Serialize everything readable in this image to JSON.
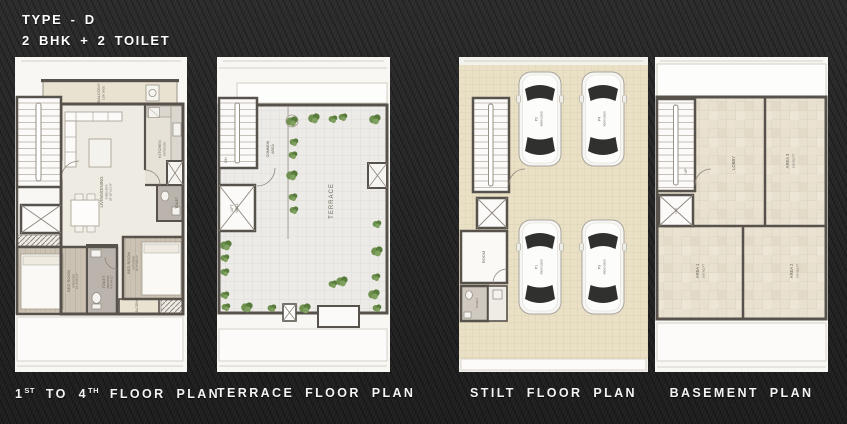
{
  "header": {
    "title": "TYPE - D",
    "subtitle": "2 BHK + 2 TOILET"
  },
  "captions": {
    "plan1": {
      "p1": "1",
      "s1": "ST",
      "p2": " TO 4",
      "s2": "TH",
      "p3": " FLOOR PLAN"
    },
    "plan2": "TERRACE FLOOR PLAN",
    "plan3": "STILT FLOOR PLAN",
    "plan4": "BASEMENT PLAN"
  },
  "floor_plan": {
    "balcony_top": "BALCONY",
    "balcony_top_dim": "1200 WIDE",
    "living": "LIVING/DINING",
    "living_dim_mm": "6300X3550",
    "living_dim_ft": "20'-10\"X11'-8\"",
    "kitchen": "KITCHEN",
    "kitchen_dim_mm": "2475X2150",
    "bedroom_a": "BED ROOM",
    "bedroom_a_dim_mm": "3750X3350",
    "bedroom_a_dim_ft": "12'-4\"X11'-0\"",
    "toilet_a": "TOILET",
    "toilet_a_dim_mm": "2600X1500",
    "toilet_a_dim_ft": "8'-6\"X4'-11\"",
    "bedroom_b": "BED ROOM",
    "bedroom_b_dim_mm": "3175X3050",
    "bedroom_b_dim_ft": "10'-5\"X10'-0\"",
    "toilet_b": "TOILET",
    "balcony_b": "BALCONY"
  },
  "terrace_plan": {
    "stairs": "DN",
    "lift_line1": "LIFT",
    "lift_line2": "WELL",
    "common_line1": "COMMON",
    "common_line2": "AREA",
    "terrace": "TERRACE"
  },
  "stilt_plan": {
    "room": "ROOM",
    "toilet": "TOILET",
    "cars": [
      {
        "id": "P2",
        "size": "4500X2500"
      },
      {
        "id": "P4",
        "size": "4500X2500"
      },
      {
        "id": "P1",
        "size": "4500X2500"
      },
      {
        "id": "P3",
        "size": "4500X2500"
      }
    ]
  },
  "basement_plan": {
    "stairs": "UP",
    "lift": "LIFT",
    "lobby": "LOBBY",
    "area1": "AREA 1",
    "area1_size": "160 SQ.FT",
    "area2": "AREA 2",
    "area2_size": "160 SQ.FT",
    "area3": "AREA 3",
    "area3_size": "160 SQ.FT"
  },
  "colors": {
    "background": "#232323",
    "panel": "#f8f7f4",
    "wall": "#57524b",
    "tile_beige": "#e9e0c6",
    "plant_green": "#6f9150",
    "heading_text": "#ffffff"
  }
}
